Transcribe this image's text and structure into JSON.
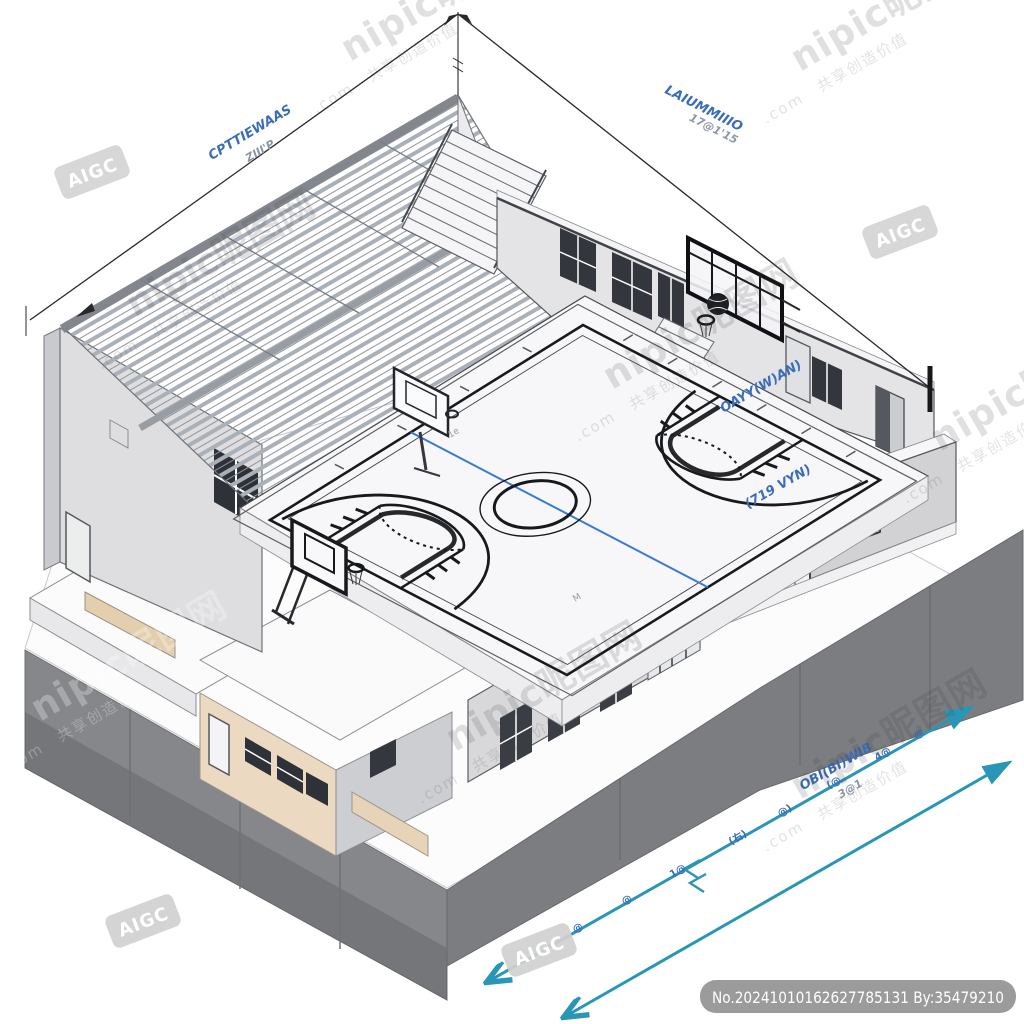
{
  "watermark": {
    "brand": "nipic昵图网",
    "domain": ".com",
    "slogan": "共享创造价值"
  },
  "badges": {
    "aigc": "AIGC",
    "image_id": "No.20241010162627785131 By:35479210"
  },
  "dimension_labels": {
    "top_left_line1": "CPTTIEWAAS",
    "top_left_line2": "ZIII'P",
    "top_right_line1": "LAIUMMIIIO",
    "top_right_line2": "17@1'15",
    "right_wall": "OAYY(W)AN)",
    "right_court": "(719 VYN)",
    "bottom_label_line1": "OBI(BI)WIB",
    "bottom_label_line2": "3@1",
    "bottom_ticks": [
      "@",
      "@",
      "1@",
      "(右)",
      "@)",
      "(@",
      "4@",
      "@"
    ],
    "court_marks": [
      "1e",
      "M"
    ]
  },
  "colors": {
    "dimension_blue": "#3a6db8",
    "arrow_teal": "#2a96b6",
    "court_line_blue": "#3a7ad0",
    "base_dark": "#828487",
    "annex_tan": "#ecd9c2",
    "wall_gray": "#e4e4e7",
    "watermark_gray": "#c9c9c9"
  }
}
